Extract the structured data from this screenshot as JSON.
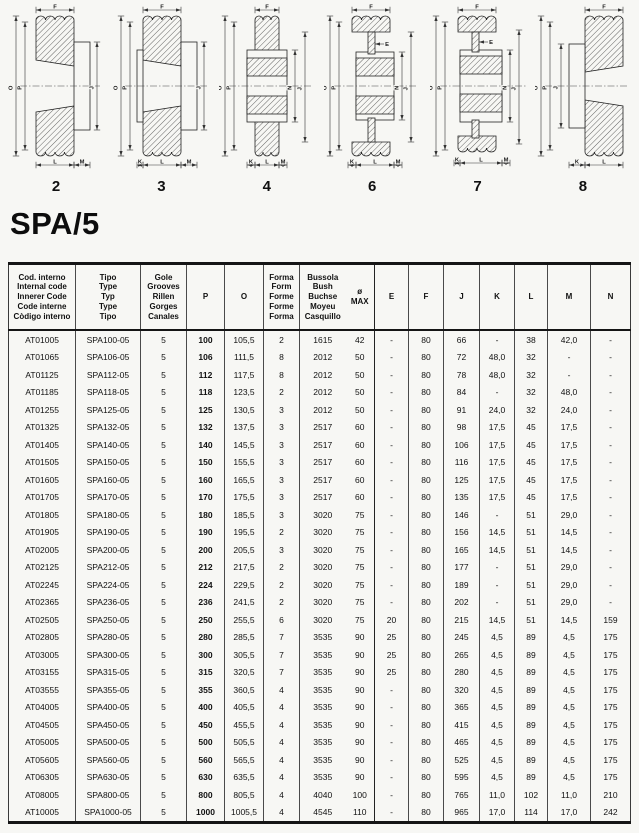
{
  "page_title": "SPA/5",
  "diagrams": [
    {
      "form": "2",
      "dims": [
        "F",
        "O",
        "P",
        "J",
        "L",
        "M"
      ]
    },
    {
      "form": "3",
      "dims": [
        "F",
        "O",
        "P",
        "J",
        "K",
        "L",
        "M"
      ]
    },
    {
      "form": "4",
      "dims": [
        "F",
        "O",
        "P",
        "N",
        "J",
        "K",
        "L",
        "M"
      ]
    },
    {
      "form": "6",
      "dims": [
        "F",
        "E",
        "O",
        "P",
        "N",
        "J",
        "K",
        "L",
        "M"
      ]
    },
    {
      "form": "7",
      "dims": [
        "F",
        "E",
        "O",
        "P",
        "N",
        "J",
        "K",
        "L",
        "M"
      ]
    },
    {
      "form": "8",
      "dims": [
        "F",
        "O",
        "P",
        "J",
        "K",
        "L"
      ]
    }
  ],
  "table": {
    "headers": [
      {
        "id": "code",
        "text": "Cod. interno\nInternal code\nInnerer Code\nCode interne\nCòdigo interno"
      },
      {
        "id": "type",
        "text": "Tipo\nType\nTyp\nType\nTipo"
      },
      {
        "id": "grooves",
        "text": "Gole\nGrooves\nRillen\nGorges\nCanales"
      },
      {
        "id": "p",
        "text": "P"
      },
      {
        "id": "o",
        "text": "O"
      },
      {
        "id": "form",
        "text": "Forma\nForm\nForme\nForme\nForma"
      },
      {
        "id": "bush",
        "text": "Bussola\nBush\nBuchse\nMoyeu\nCasquillo"
      },
      {
        "id": "omax",
        "text": "ø\nMAX"
      },
      {
        "id": "e",
        "text": "E"
      },
      {
        "id": "f",
        "text": "F"
      },
      {
        "id": "j",
        "text": "J"
      },
      {
        "id": "k",
        "text": "K"
      },
      {
        "id": "l",
        "text": "L"
      },
      {
        "id": "m",
        "text": "M"
      },
      {
        "id": "n",
        "text": "N"
      }
    ],
    "rows": [
      [
        "AT01005",
        "SPA100-05",
        "5",
        "100",
        "105,5",
        "2",
        "1615",
        "42",
        "-",
        "80",
        "66",
        "-",
        "38",
        "42,0",
        "-"
      ],
      [
        "AT01065",
        "SPA106-05",
        "5",
        "106",
        "111,5",
        "8",
        "2012",
        "50",
        "-",
        "80",
        "72",
        "48,0",
        "32",
        "-",
        "-"
      ],
      [
        "AT01125",
        "SPA112-05",
        "5",
        "112",
        "117,5",
        "8",
        "2012",
        "50",
        "-",
        "80",
        "78",
        "48,0",
        "32",
        "-",
        "-"
      ],
      [
        "AT01185",
        "SPA118-05",
        "5",
        "118",
        "123,5",
        "2",
        "2012",
        "50",
        "-",
        "80",
        "84",
        "-",
        "32",
        "48,0",
        "-"
      ],
      [
        "AT01255",
        "SPA125-05",
        "5",
        "125",
        "130,5",
        "3",
        "2012",
        "50",
        "-",
        "80",
        "91",
        "24,0",
        "32",
        "24,0",
        "-"
      ],
      [
        "AT01325",
        "SPA132-05",
        "5",
        "132",
        "137,5",
        "3",
        "2517",
        "60",
        "-",
        "80",
        "98",
        "17,5",
        "45",
        "17,5",
        "-"
      ],
      [
        "AT01405",
        "SPA140-05",
        "5",
        "140",
        "145,5",
        "3",
        "2517",
        "60",
        "-",
        "80",
        "106",
        "17,5",
        "45",
        "17,5",
        "-"
      ],
      [
        "AT01505",
        "SPA150-05",
        "5",
        "150",
        "155,5",
        "3",
        "2517",
        "60",
        "-",
        "80",
        "116",
        "17,5",
        "45",
        "17,5",
        "-"
      ],
      [
        "AT01605",
        "SPA160-05",
        "5",
        "160",
        "165,5",
        "3",
        "2517",
        "60",
        "-",
        "80",
        "125",
        "17,5",
        "45",
        "17,5",
        "-"
      ],
      [
        "AT01705",
        "SPA170-05",
        "5",
        "170",
        "175,5",
        "3",
        "2517",
        "60",
        "-",
        "80",
        "135",
        "17,5",
        "45",
        "17,5",
        "-"
      ],
      [
        "AT01805",
        "SPA180-05",
        "5",
        "180",
        "185,5",
        "3",
        "3020",
        "75",
        "-",
        "80",
        "146",
        "-",
        "51",
        "29,0",
        "-"
      ],
      [
        "AT01905",
        "SPA190-05",
        "5",
        "190",
        "195,5",
        "2",
        "3020",
        "75",
        "-",
        "80",
        "156",
        "14,5",
        "51",
        "14,5",
        "-"
      ],
      [
        "AT02005",
        "SPA200-05",
        "5",
        "200",
        "205,5",
        "3",
        "3020",
        "75",
        "-",
        "80",
        "165",
        "14,5",
        "51",
        "14,5",
        "-"
      ],
      [
        "AT02125",
        "SPA212-05",
        "5",
        "212",
        "217,5",
        "2",
        "3020",
        "75",
        "-",
        "80",
        "177",
        "-",
        "51",
        "29,0",
        "-"
      ],
      [
        "AT02245",
        "SPA224-05",
        "5",
        "224",
        "229,5",
        "2",
        "3020",
        "75",
        "-",
        "80",
        "189",
        "-",
        "51",
        "29,0",
        "-"
      ],
      [
        "AT02365",
        "SPA236-05",
        "5",
        "236",
        "241,5",
        "2",
        "3020",
        "75",
        "-",
        "80",
        "202",
        "-",
        "51",
        "29,0",
        "-"
      ],
      [
        "AT02505",
        "SPA250-05",
        "5",
        "250",
        "255,5",
        "6",
        "3020",
        "75",
        "20",
        "80",
        "215",
        "14,5",
        "51",
        "14,5",
        "159"
      ],
      [
        "AT02805",
        "SPA280-05",
        "5",
        "280",
        "285,5",
        "7",
        "3535",
        "90",
        "25",
        "80",
        "245",
        "4,5",
        "89",
        "4,5",
        "175"
      ],
      [
        "AT03005",
        "SPA300-05",
        "5",
        "300",
        "305,5",
        "7",
        "3535",
        "90",
        "25",
        "80",
        "265",
        "4,5",
        "89",
        "4,5",
        "175"
      ],
      [
        "AT03155",
        "SPA315-05",
        "5",
        "315",
        "320,5",
        "7",
        "3535",
        "90",
        "25",
        "80",
        "280",
        "4,5",
        "89",
        "4,5",
        "175"
      ],
      [
        "AT03555",
        "SPA355-05",
        "5",
        "355",
        "360,5",
        "4",
        "3535",
        "90",
        "-",
        "80",
        "320",
        "4,5",
        "89",
        "4,5",
        "175"
      ],
      [
        "AT04005",
        "SPA400-05",
        "5",
        "400",
        "405,5",
        "4",
        "3535",
        "90",
        "-",
        "80",
        "365",
        "4,5",
        "89",
        "4,5",
        "175"
      ],
      [
        "AT04505",
        "SPA450-05",
        "5",
        "450",
        "455,5",
        "4",
        "3535",
        "90",
        "-",
        "80",
        "415",
        "4,5",
        "89",
        "4,5",
        "175"
      ],
      [
        "AT05005",
        "SPA500-05",
        "5",
        "500",
        "505,5",
        "4",
        "3535",
        "90",
        "-",
        "80",
        "465",
        "4,5",
        "89",
        "4,5",
        "175"
      ],
      [
        "AT05605",
        "SPA560-05",
        "5",
        "560",
        "565,5",
        "4",
        "3535",
        "90",
        "-",
        "80",
        "525",
        "4,5",
        "89",
        "4,5",
        "175"
      ],
      [
        "AT06305",
        "SPA630-05",
        "5",
        "630",
        "635,5",
        "4",
        "3535",
        "90",
        "-",
        "80",
        "595",
        "4,5",
        "89",
        "4,5",
        "175"
      ],
      [
        "AT08005",
        "SPA800-05",
        "5",
        "800",
        "805,5",
        "4",
        "4040",
        "100",
        "-",
        "80",
        "765",
        "11,0",
        "102",
        "11,0",
        "210"
      ],
      [
        "AT10005",
        "SPA1000-05",
        "5",
        "1000",
        "1005,5",
        "4",
        "4545",
        "110",
        "-",
        "80",
        "965",
        "17,0",
        "114",
        "17,0",
        "242"
      ]
    ]
  }
}
